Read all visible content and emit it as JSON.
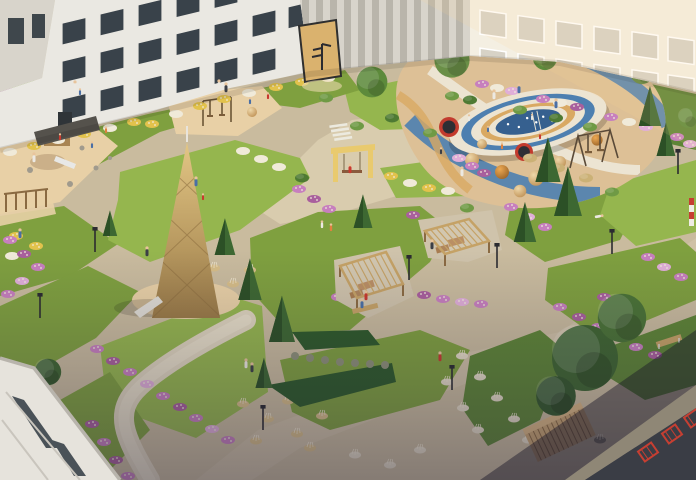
{
  "meta": {
    "description": "Aerial architectural rendering of a landscaped residential courtyard at dusk, surrounded by white apartment buildings, with playgrounds, winding paths, flower beds and pergolas",
    "style": "photorealistic 3D visualization",
    "view": "high oblique aerial view"
  },
  "palette": {
    "paving": "#c9bb9e",
    "paving-light": "#d9ccae",
    "gravel": "#ded4bd",
    "gravel-light": "#e7dec9",
    "sand": "#e8d0a6",
    "lawn": "#7fa03f",
    "lawn-light": "#95b64e",
    "lawn-dark": "#5e8536",
    "conifer": "#3d6832",
    "conifer-shade": "#2c5026",
    "hedge": "#2e5a2a",
    "flower-pink": "#c77fbe",
    "flower-magenta": "#a95f9d",
    "flower-lilac": "#e0aed8",
    "flower-yellow": "#e2c24c",
    "flower-white": "#f0ead9",
    "grass-tan": "#d6bd88",
    "grass-fluff": "#e2d9c4",
    "wood": "#c5a266",
    "wood-dark": "#8a6a42",
    "wood-light": "#e2c588",
    "swing-yellow": "#e9ca6e",
    "rubber-base": "#ddc096",
    "rubber-blue": "#4d7fb0",
    "rubber-cream": "#ece4d2",
    "rubber-tan": "#d9a963",
    "pit-blue": "#36608f",
    "trampoline-red": "#c23b2e",
    "balcony-red": "#c63f32",
    "building-white": "#eae8e2",
    "building-warm": "#f4efe2",
    "building-grey": "#d8d4cb",
    "building-stripe": "#b9b5ab",
    "window-dark": "#39424a",
    "window-warm": "#d7d2c6",
    "stone": "#8f8776",
    "facade-dark": "#3a3d45",
    "person-skin": "#e8c49c",
    "person-red": "#c8392f",
    "person-blue": "#4a6fa5",
    "person-white": "#ece9e2",
    "person-dark": "#3c3f46",
    "person-orange": "#e0813f",
    "lamp": "#2b2b30"
  },
  "scene": {
    "areas": {
      "left_building": "white brick residential building with dark windows and entrance awning",
      "center_building": "grey striped tower volume with tan entrance portal",
      "right_building": "sunlit warm-white residential building",
      "far_left_building": "grey building corner beside alley",
      "corner_building_sw": "foreground building corner, bottom left",
      "corner_building_se": "building roofline with red balcony grilles, bottom right",
      "sand_playground": "sand play area with wooden hut, slide mound and boulders",
      "toddler_swings": "small sand patch with frame swing",
      "teepee": "wooden lattice teepee climbing tower on sand pad",
      "swing_portal": "yellow portal frame swing on plaza",
      "oval_playground": "oval climbing ring with striped walls on blue-and-tan rubber surface",
      "trampolines": "round in-ground trampolines with red rims",
      "play_domes": "climbing half-dome mounds",
      "swing_set": "timber A-frame swing set",
      "pergola_one": "wooden pergola with loungers",
      "pergola_two": "wooden pergola with loungers and bench",
      "deck_bench": "slatted timber deck seating",
      "garden_bench": "wooden bench on lawn",
      "hedge": "clipped evergreen hedge wedge",
      "gravel_path": "winding gravel footpath",
      "walkway": "paved diagonal walkways",
      "flower_borders": "pink, purple, yellow and white perennial flower borders",
      "ornamental_grasses": "tan and fluffy seed-head ornamental grasses",
      "conifers": "spruce trees",
      "trees": "deciduous courtyard trees",
      "lamps": "dark park light poles",
      "people": "residents and children walking, sitting and playing"
    },
    "counts": {
      "pergolas": 2,
      "trampolines": 2,
      "red_balconies": 3,
      "swing_portals": 1
    }
  }
}
